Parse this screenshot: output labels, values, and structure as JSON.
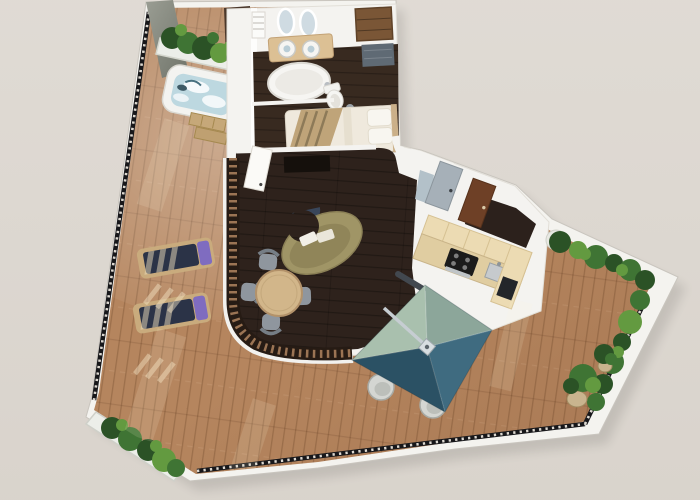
{
  "scene": {
    "title": "3D floor plan render of a suite with wrap-around terrace",
    "rooms": [
      "terrace",
      "spa-deck",
      "bathroom",
      "bedroom",
      "living-room",
      "dining-area",
      "kitchen",
      "entry-hall"
    ],
    "objects": [
      "concrete-privacy-wall",
      "planter-box",
      "hot-tub",
      "deck-steps",
      "sun-lounger",
      "glass-railing",
      "bathroom-vanity",
      "vanity-mirrors",
      "towel-ladder",
      "bathtub",
      "toilet",
      "wardrobe",
      "shower-mat",
      "double-bed",
      "tv-niche",
      "interior-door",
      "curved-sofa",
      "coffee-table",
      "dining-table",
      "dining-chairs",
      "kitchen-cabinets",
      "cooktop",
      "kitchen-sink",
      "entry-door-gray",
      "entry-door-brown",
      "cantilever-parasol",
      "parasol-arm",
      "outdoor-stools",
      "potted-plants",
      "corner-planter",
      "side-planter-hedge"
    ]
  },
  "colors": {
    "background": "#dcd7d1",
    "footprint_trim": "#f4f3ef",
    "terrace_wood": "#b5855e",
    "interior_floor": "#2e221c",
    "bathroom_floor": "#382a20",
    "wall_white": "#f4f3f0",
    "railing": "#17171a",
    "concrete_wall": "#8f9287",
    "planter_box": "#eceee9",
    "plant_dark": "#2b5226",
    "plant_mid": "#3f7434",
    "plant_light": "#639a40",
    "hot_tub_shell": "#f3f3f0",
    "hot_tub_water": "#bdd8e0",
    "deck_steps": "#c6a879",
    "lounger_frame": "#c9ab7d",
    "lounger_cushion": "#2b3347",
    "lounger_pillow": "#7f6cc0",
    "bed_linen": "#efe9dd",
    "bed_throw": "#bfa479",
    "vanity_wood": "#dcc094",
    "fixture_white": "#f6f5f2",
    "wardrobe_wood": "#7a5636",
    "shower_slate": "#5f6a74",
    "sofa_body": "#a09566",
    "sofa_seat": "#8b8056",
    "coffee_table": "#39465a",
    "dining_table": "#d2b68a",
    "chair_gray": "#8f969e",
    "kitchen_cabinet": "#ecdbb3",
    "kitchen_counter": "#e0cda1",
    "cooktop_black": "#1b1b1b",
    "steel": "#bfc4c7",
    "door_gray": "#a6b0b8",
    "door_brown": "#6e4026",
    "hall_floor": "#2c211c",
    "umbrella_nw": "#a9c0ae",
    "umbrella_ne": "#8ca69a",
    "umbrella_sw": "#2b5164",
    "umbrella_se": "#3f6b80",
    "stool": "#d4d6d2",
    "pot": "#c9b48e",
    "sun_patch": "#fff3dc"
  }
}
